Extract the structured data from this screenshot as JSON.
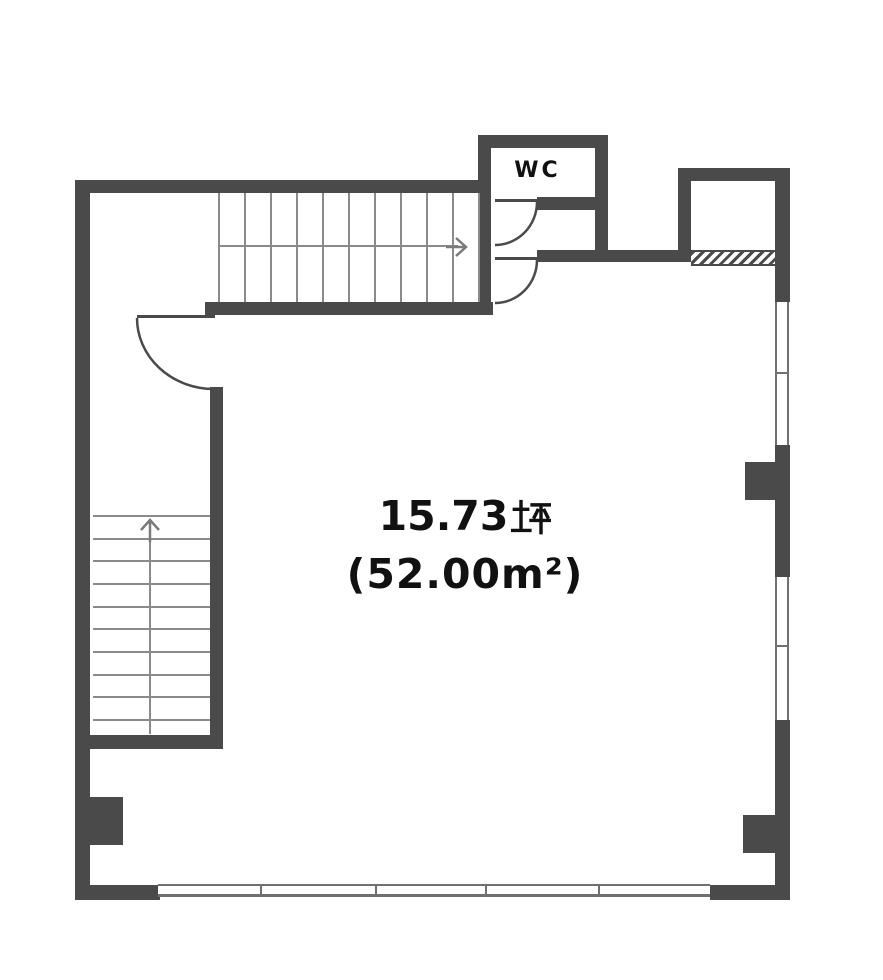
{
  "plan": {
    "wc_label": "WC",
    "room_area_line1": "15.73坪",
    "room_area_line2": "(52.00㎡)",
    "area_display": {
      "tsubo_value": "15.73",
      "tsubo_unit": "坪",
      "m2_display": "(52.00m²)"
    }
  },
  "floor_plan": {
    "top_stairs_tread_count": 11,
    "left_stairs_tread_count": 10,
    "top_stairs_direction": "right",
    "left_stairs_direction": "up"
  },
  "colors": {
    "wall": "#4a4a4a",
    "stair_line": "#8a8a8a",
    "window_line": "#707070",
    "text": "#111111",
    "background": "#ffffff"
  }
}
